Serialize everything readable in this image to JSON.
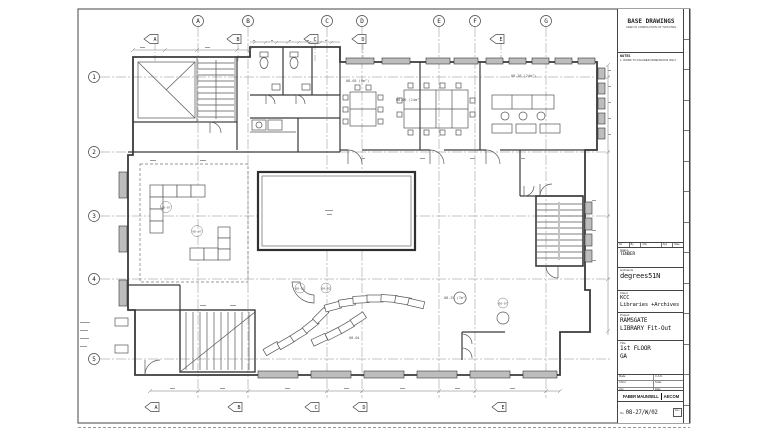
{
  "colors": {
    "paper": "#ffffff",
    "wall_line": "#3a3a3a",
    "grid_line": "#8a8a8a",
    "bay_fill": "#bdbdbd",
    "speckle": "#9a9a9a"
  },
  "sheet": {
    "grid_top": [
      "A",
      "B",
      "C",
      "D",
      "E",
      "F",
      "G"
    ],
    "grid_left": [
      "1",
      "2",
      "3",
      "4",
      "5"
    ],
    "sections_top": [
      "A",
      "B",
      "C",
      "D",
      "E"
    ],
    "sections_bottom": [
      "A",
      "B",
      "C",
      "D",
      "E"
    ]
  },
  "plan": {
    "annotations": [
      "08-05 (9m²)",
      "08-06 (14m²)",
      "08-26 (24m²)",
      "08-07",
      "08-07",
      "08-01",
      "08-02",
      "08-25 (7m²)",
      "08-07",
      "08-04"
    ]
  },
  "title_block": {
    "base_drawings_title": "BASE DRAWINGS",
    "base_drawings_subtitle": "USED IN COMPILATION OF THIS DWG",
    "notes_label": "NOTES",
    "note_1": "1. WORK TO FIGURED DIMENSIONS ONLY",
    "revision_columns": [
      "No",
      "By",
      "Chk",
      "App",
      "Date"
    ],
    "status_label": "Status",
    "status_value": "TENDER",
    "architects_label": "Architects",
    "architects_value": "degrees51N",
    "client_label": "Client",
    "client_line1": "KCC",
    "client_line2": "Libraries +Archives",
    "project_label": "Project",
    "project_line1": "RAMSGATE",
    "project_line2": "LIBRARY Fit-Out",
    "title_label": "Title",
    "title_line1": "1st FLOOR",
    "title_line2": "GA",
    "made_label": "Made",
    "cad_label": "C.A.D.",
    "chkd_label": "Chk'd",
    "scale_label": "Scale",
    "app_label": "App",
    "date_label": "Date",
    "logo_left": "FABER MAUNSELL",
    "logo_right": "AECOM",
    "number_label": "No.",
    "number_value": "08-27/W/02",
    "rev_label": "Rev"
  }
}
